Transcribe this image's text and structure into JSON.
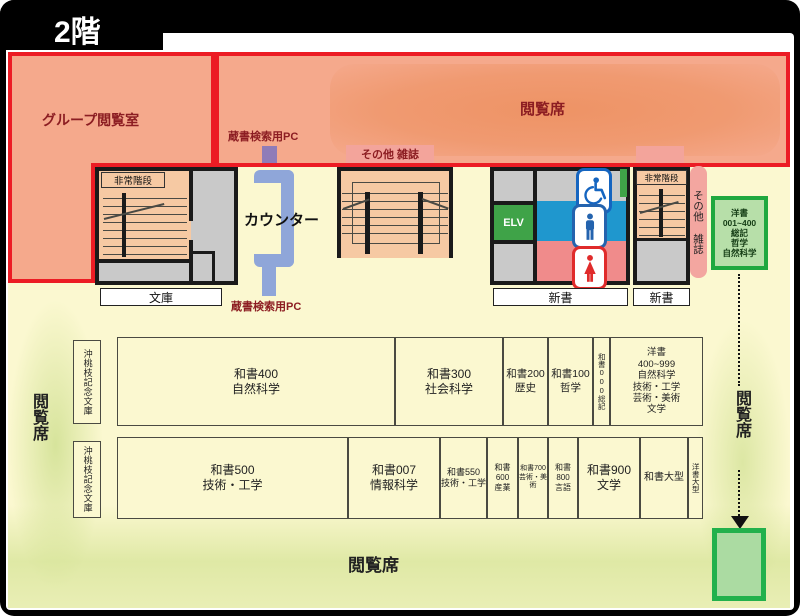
{
  "title": "2階",
  "colors": {
    "red_border": "#ec1c24",
    "room_salmon": "#f5a98c",
    "room_salmon_dark": "#ee9365",
    "floor_yellow": "#fbf8d0",
    "stairs_peach": "#f6c9a3",
    "gray_room": "#c9c9c9",
    "wall_black": "#1a1a1a",
    "green_border": "#22b14c",
    "green_fill": "#b2dcaa",
    "counter_blue": "#8fa6d9",
    "opac_purple": "#8f7cb8",
    "toilet_blue": "#1f97ce",
    "toilet_pink": "#f08b8b",
    "magazine_pink": "#f3a6a0",
    "label_maroon": "#8c1d22",
    "reading_green": "#dce9a8"
  },
  "areas": {
    "group_room": "グループ閲覧室",
    "reading_top": "閲覧席",
    "reading_left": "閲覧席",
    "reading_right": "閲覧席",
    "reading_bottom": "閲覧席",
    "counter": "カウンター",
    "opac_top": "蔵書検索用PC",
    "opac_bottom": "蔵書検索用PC",
    "magazines_top": "その他 雑誌",
    "magazines_side": "その他 雑誌",
    "stairs_left": "非常階段",
    "stairs_right": "非常階段",
    "elevator": "ELV",
    "bunko": "文庫",
    "shinsho_center": "新書",
    "shinsho_right": "新書",
    "yosho_guide": "洋書\n001~400\n総記\n哲学\n自然科学",
    "memorial_row1": "沖桃枝記念文庫",
    "memorial_row2": "沖桃枝記念文庫"
  },
  "shelves": {
    "row1": [
      {
        "label": "和書400\n自然科学"
      },
      {
        "label": "和書300\n社会科学"
      },
      {
        "label": "和書200\n歴史"
      },
      {
        "label": "和書100\n哲学"
      },
      {
        "label": "和書000総記"
      },
      {
        "label": "洋書\n400~999\n自然科学\n技術・工学\n芸術・美術\n文学"
      }
    ],
    "row2": [
      {
        "label": "和書500\n技術・工学"
      },
      {
        "label": "和書007\n情報科学"
      },
      {
        "label": "和書550\n技術・工学"
      },
      {
        "label": "和書600\n産業"
      },
      {
        "label": "和書700\n芸術・美術"
      },
      {
        "label": "和書800\n言語"
      },
      {
        "label": "和書900\n文学"
      },
      {
        "label": "和書大型"
      },
      {
        "label": "洋書大型"
      }
    ]
  }
}
